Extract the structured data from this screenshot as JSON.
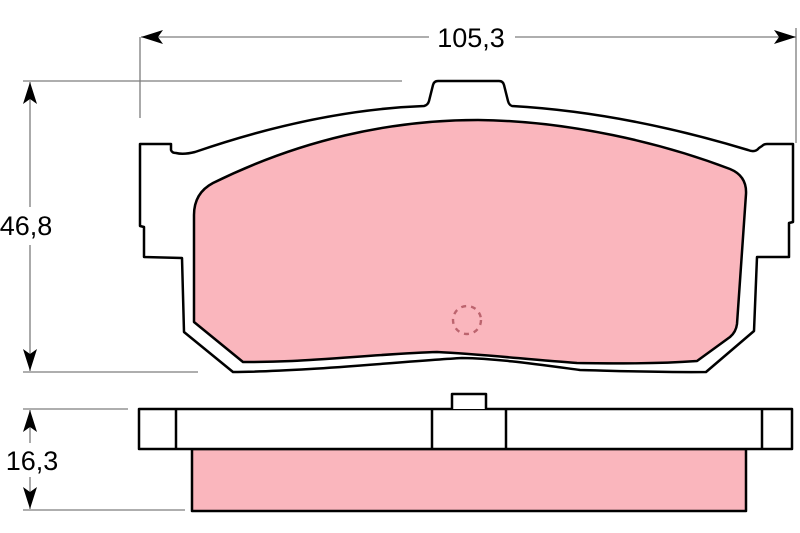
{
  "dimensions": {
    "width": "105,3",
    "height": "46,8",
    "thickness": "16,3"
  },
  "colors": {
    "friction_pink": "#fab6bd",
    "outline_black": "#000000",
    "dimension_gray": "#7d7d7d",
    "wear_mark_red": "#bc646e",
    "background": "#ffffff"
  }
}
